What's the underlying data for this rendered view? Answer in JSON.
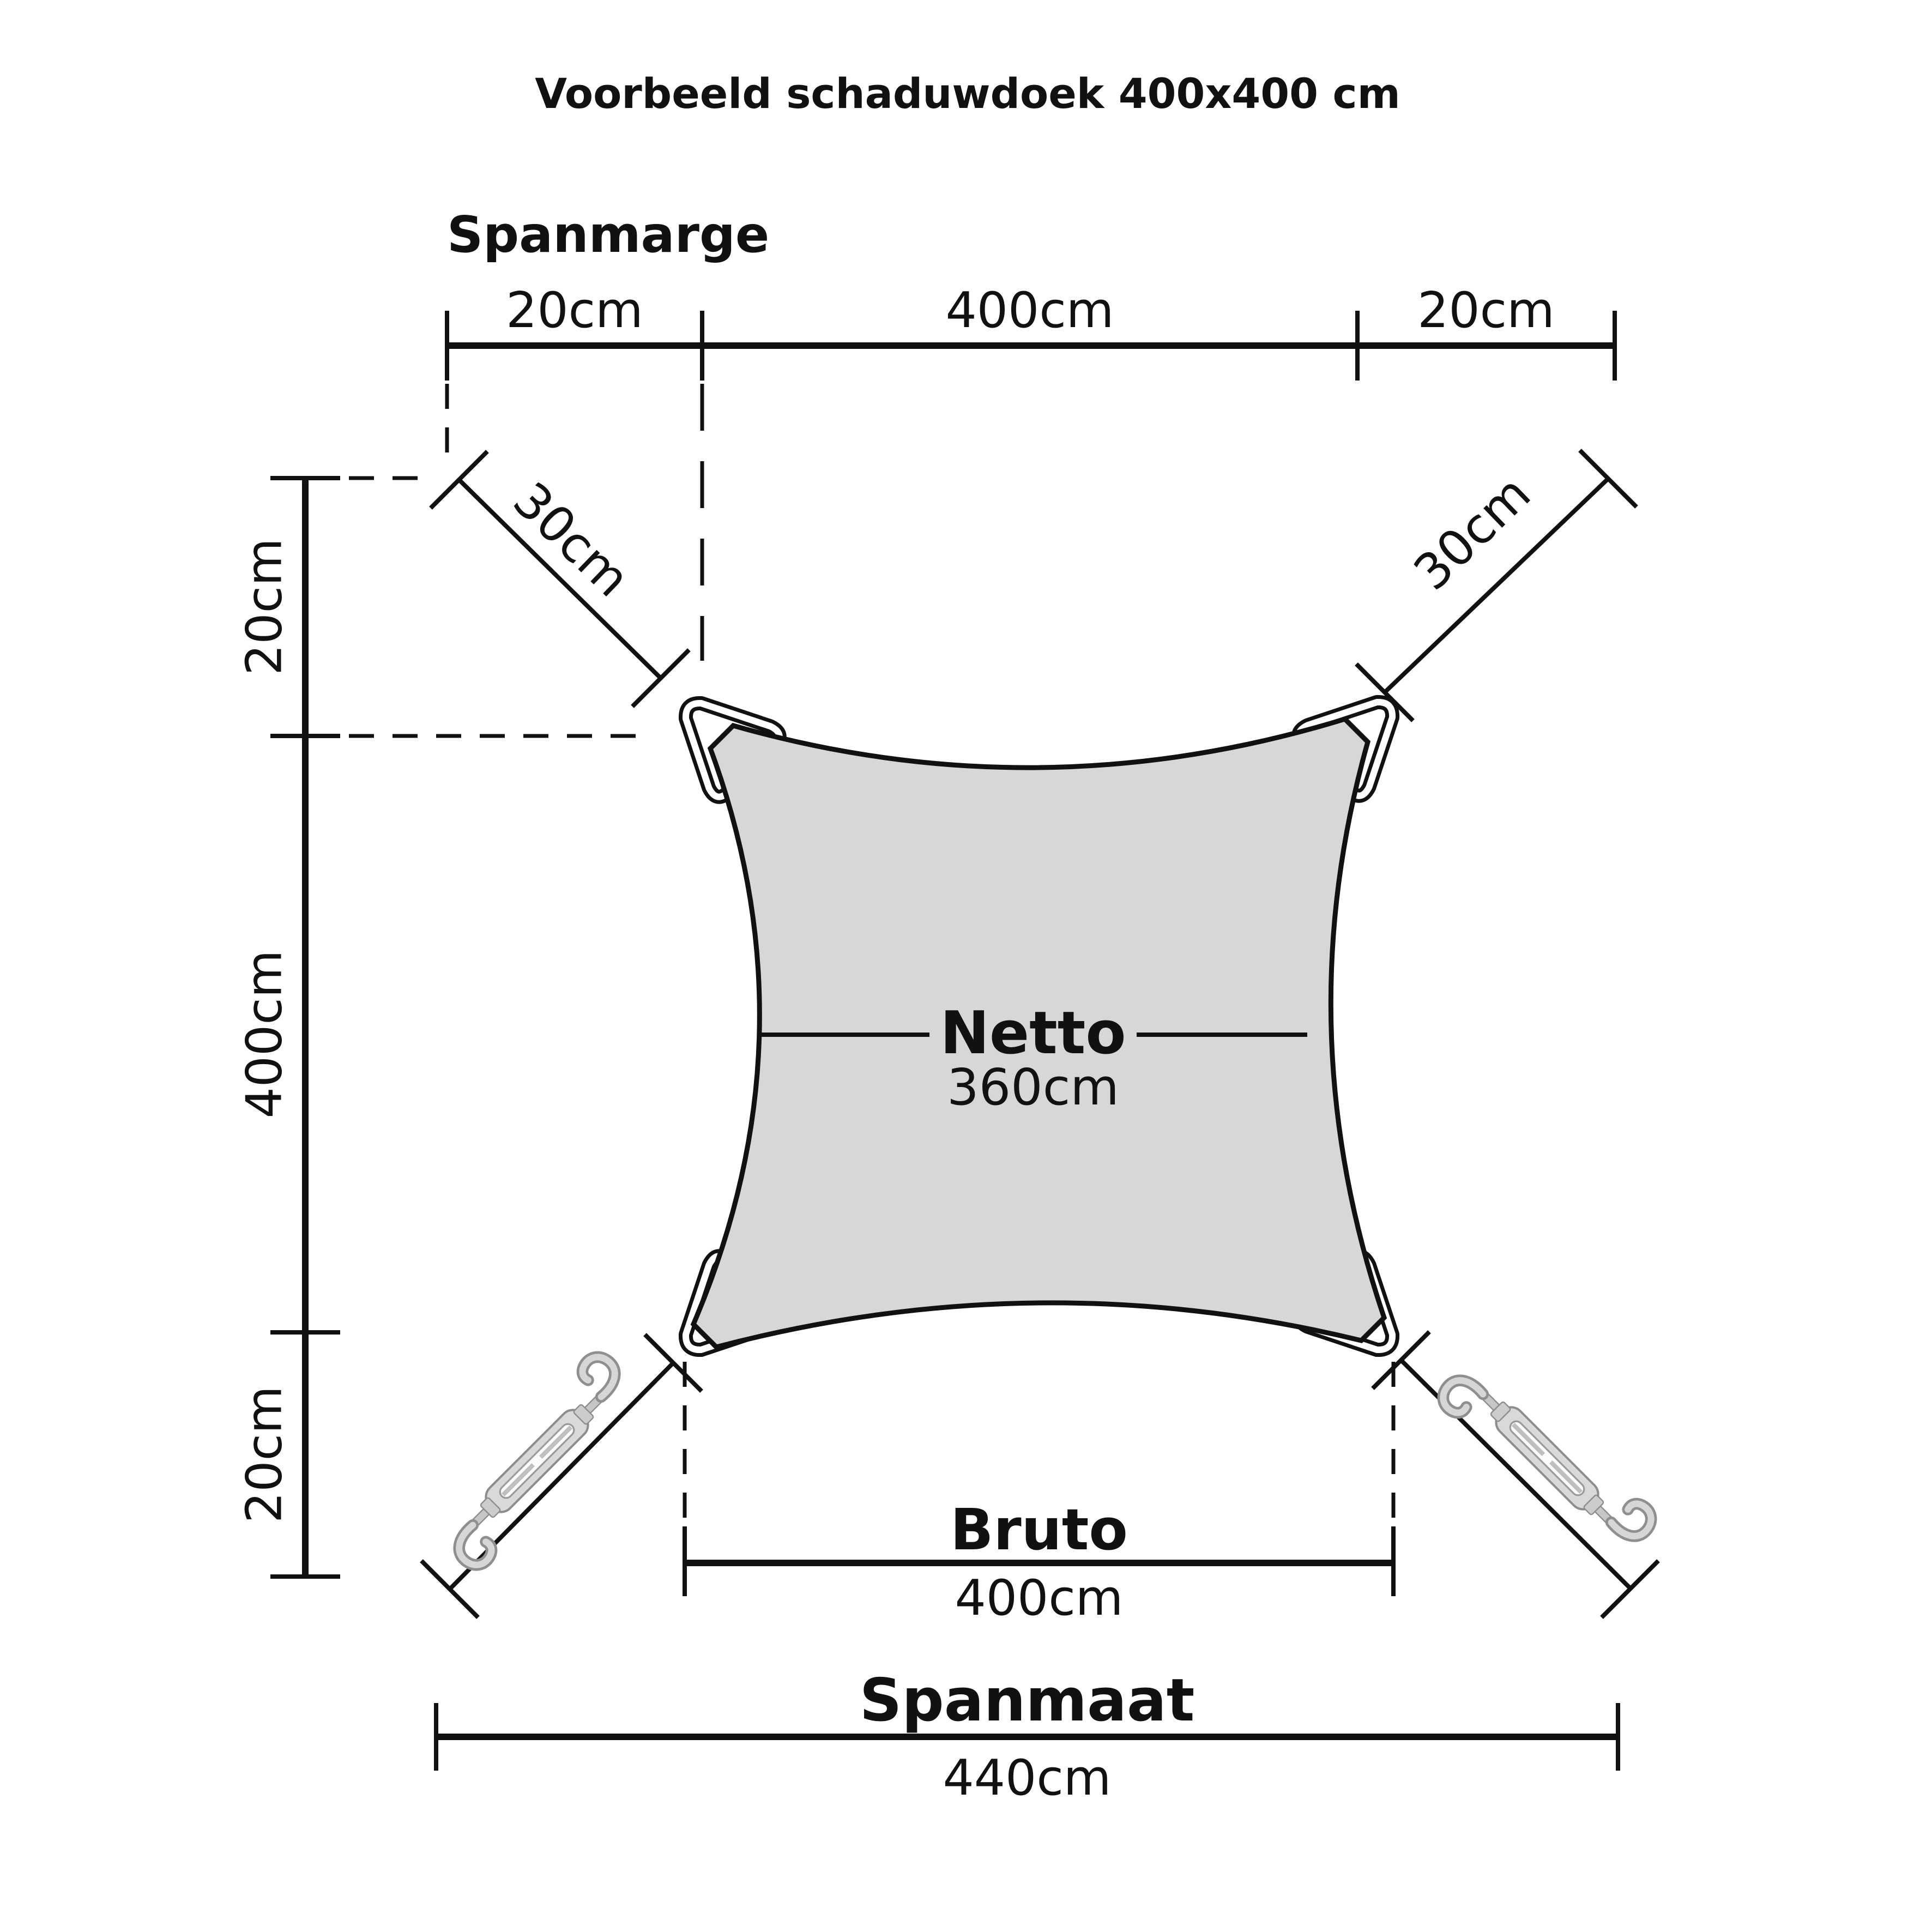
{
  "title": "Voorbeeld schaduwdoek 400x400 cm",
  "spanmarge": {
    "heading": "Spanmarge"
  },
  "top_dimension": {
    "segments": [
      "20cm",
      "400cm",
      "20cm"
    ]
  },
  "left_dimension": {
    "segments": [
      "20cm",
      "400cm",
      "20cm"
    ]
  },
  "corner_offsets": {
    "top_left": "30cm",
    "top_right": "30cm"
  },
  "netto": {
    "label": "Netto",
    "value": "360cm"
  },
  "bruto": {
    "label": "Bruto",
    "value": "400cm"
  },
  "spanmaat": {
    "label": "Spanmaat",
    "value": "440cm"
  },
  "colors": {
    "sail_fill": "#d7d7d7",
    "line": "#111111"
  },
  "icons": {
    "corner_ring": "triangle-ring-icon",
    "turnbuckle": "turnbuckle-icon"
  }
}
